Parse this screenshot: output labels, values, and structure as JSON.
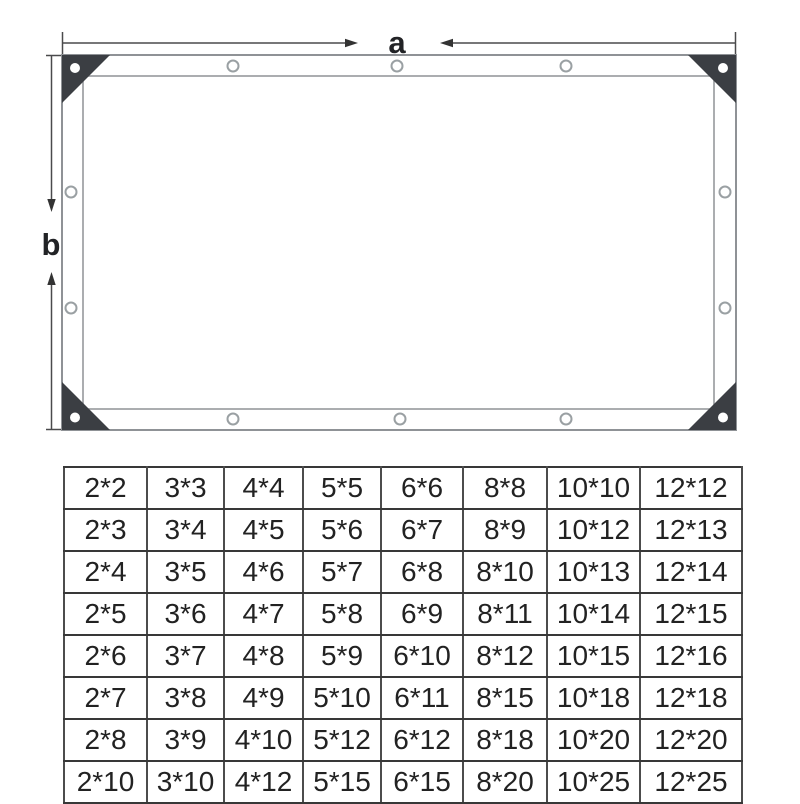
{
  "diagram": {
    "width_label": "a",
    "height_label": "b",
    "colors": {
      "tarp_outline": "#8f9296",
      "corner_patch": "#3b3e43",
      "dimension_line": "#4a4a4c",
      "label_text": "#222326",
      "grommet_ring": "#9aa0a3"
    }
  },
  "size_table": {
    "border_color": "#383838",
    "text_color": "#222222",
    "rows": [
      [
        "2*2",
        "3*3",
        "4*4",
        "5*5",
        "6*6",
        "8*8",
        "10*10",
        "12*12"
      ],
      [
        "2*3",
        "3*4",
        "4*5",
        "5*6",
        "6*7",
        "8*9",
        "10*12",
        "12*13"
      ],
      [
        "2*4",
        "3*5",
        "4*6",
        "5*7",
        "6*8",
        "8*10",
        "10*13",
        "12*14"
      ],
      [
        "2*5",
        "3*6",
        "4*7",
        "5*8",
        "6*9",
        "8*11",
        "10*14",
        "12*15"
      ],
      [
        "2*6",
        "3*7",
        "4*8",
        "5*9",
        "6*10",
        "8*12",
        "10*15",
        "12*16"
      ],
      [
        "2*7",
        "3*8",
        "4*9",
        "5*10",
        "6*11",
        "8*15",
        "10*18",
        "12*18"
      ],
      [
        "2*8",
        "3*9",
        "4*10",
        "5*12",
        "6*12",
        "8*18",
        "10*20",
        "12*20"
      ],
      [
        "2*10",
        "3*10",
        "4*12",
        "5*15",
        "6*15",
        "8*20",
        "10*25",
        "12*25"
      ]
    ]
  }
}
